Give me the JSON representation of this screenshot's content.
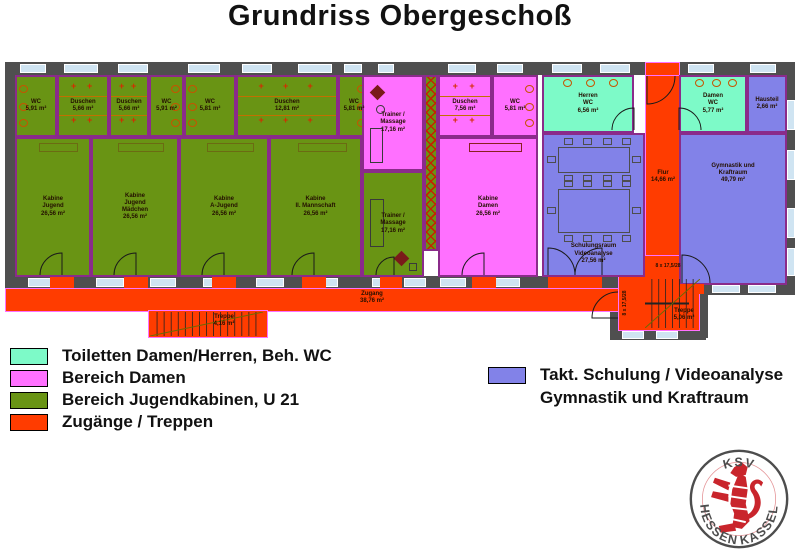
{
  "title": "Grundriss Obergeschoß",
  "colors": {
    "olive": "#699414",
    "pink": "#FF70FF",
    "teal": "#7DFAC8",
    "purple": "#8282E8",
    "orange": "#FF3C00",
    "wall": "#4F4F4F",
    "window": "#CFE4F2",
    "room_border": "#8A2B8A",
    "accent_red": "#D42B00"
  },
  "plan": {
    "walls": [
      [
        5,
        62,
        790,
        13
      ],
      [
        5,
        62,
        10,
        228
      ],
      [
        785,
        62,
        10,
        233
      ],
      [
        5,
        276,
        617,
        12
      ],
      [
        700,
        283,
        95,
        12
      ],
      [
        610,
        300,
        8,
        38
      ],
      [
        610,
        330,
        96,
        10
      ],
      [
        700,
        295,
        8,
        43
      ]
    ],
    "orange_areas": [
      {
        "name": "corridor-zugang",
        "x": 5,
        "y": 288,
        "w": 617,
        "h": 24
      },
      {
        "name": "stair-left-area",
        "x": 148,
        "y": 310,
        "w": 120,
        "h": 28
      },
      {
        "name": "flur-corridor",
        "x": 645,
        "y": 75,
        "w": 35,
        "h": 215
      },
      {
        "name": "entrance-top",
        "x": 645,
        "y": 62,
        "w": 35,
        "h": 14
      },
      {
        "name": "stair-right-area",
        "x": 618,
        "y": 255,
        "w": 82,
        "h": 76
      }
    ],
    "rooms": [
      {
        "name": "wc-1",
        "fill": "olive",
        "x": 15,
        "y": 75,
        "w": 42,
        "h": 62,
        "lines": [
          "WC",
          "5,91 m²"
        ],
        "f": [
          {
            "t": "wc",
            "side": "l"
          }
        ]
      },
      {
        "name": "duschen-1",
        "fill": "olive",
        "x": 57,
        "y": 75,
        "w": 52,
        "h": 62,
        "lines": [
          "Duschen",
          "5,66 m²"
        ],
        "f": [
          {
            "t": "shower"
          }
        ]
      },
      {
        "name": "duschen-2",
        "fill": "olive",
        "x": 109,
        "y": 75,
        "w": 40,
        "h": 62,
        "lines": [
          "Duschen",
          "5,66 m²"
        ],
        "f": [
          {
            "t": "shower"
          }
        ]
      },
      {
        "name": "wc-2",
        "fill": "olive",
        "x": 149,
        "y": 75,
        "w": 35,
        "h": 62,
        "lines": [
          "WC",
          "5,91 m²"
        ],
        "f": [
          {
            "t": "wc",
            "side": "r"
          }
        ]
      },
      {
        "name": "wc-3",
        "fill": "olive",
        "x": 184,
        "y": 75,
        "w": 52,
        "h": 62,
        "lines": [
          "WC",
          "5,81 m²"
        ],
        "f": [
          {
            "t": "wc",
            "side": "l"
          }
        ]
      },
      {
        "name": "duschen-3",
        "fill": "olive",
        "x": 236,
        "y": 75,
        "w": 102,
        "h": 62,
        "lines": [
          "Duschen",
          "12,81 m²"
        ],
        "f": [
          {
            "t": "shower"
          }
        ]
      },
      {
        "name": "wc-4",
        "fill": "olive",
        "x": 338,
        "y": 75,
        "w": 32,
        "h": 62,
        "lines": [
          "WC",
          "5,81 m²"
        ],
        "f": [
          {
            "t": "wc",
            "side": "r"
          }
        ]
      },
      {
        "name": "kabine-jugend",
        "fill": "olive",
        "x": 15,
        "y": 137,
        "w": 76,
        "h": 140,
        "lines": [
          "Kabine",
          "Jugend",
          "26,56 m²"
        ],
        "f": [
          {
            "t": "rect",
            "x": "30%",
            "y": 4,
            "w": "55%",
            "h": 9,
            "bc": "#6b6b13"
          }
        ]
      },
      {
        "name": "kabine-jugend-maedchen",
        "fill": "olive",
        "x": 91,
        "y": 137,
        "w": 88,
        "h": 140,
        "lines": [
          "Kabine",
          "Jugend",
          "Mädchen",
          "26,56 m²"
        ],
        "f": [
          {
            "t": "rect",
            "x": "30%",
            "y": 4,
            "w": "55%",
            "h": 9,
            "bc": "#6b6b13"
          }
        ]
      },
      {
        "name": "kabine-a-jugend",
        "fill": "olive",
        "x": 179,
        "y": 137,
        "w": 90,
        "h": 140,
        "lines": [
          "Kabine",
          "A-Jugend",
          "26,56 m²"
        ],
        "f": [
          {
            "t": "rect",
            "x": "30%",
            "y": 4,
            "w": "55%",
            "h": 9,
            "bc": "#6b6b13"
          }
        ]
      },
      {
        "name": "kabine-2-mannschaft",
        "fill": "olive",
        "x": 269,
        "y": 137,
        "w": 93,
        "h": 140,
        "lines": [
          "Kabine",
          "II. Mannschaft",
          "26,56 m²"
        ],
        "f": [
          {
            "t": "rect",
            "x": "30%",
            "y": 4,
            "w": "55%",
            "h": 9,
            "bc": "#6b6b13"
          }
        ]
      },
      {
        "name": "trainer-massage-damen",
        "fill": "pink",
        "x": 362,
        "y": 75,
        "w": 62,
        "h": 96,
        "lines": [
          "Trainer /",
          "Massage",
          "17,16 m²"
        ],
        "f": [
          {
            "t": "diamond",
            "x": 8,
            "y": 10,
            "s": 11
          },
          {
            "t": "ring",
            "x": 12,
            "y": 28,
            "d": 9
          },
          {
            "t": "rect",
            "x": 6,
            "y": "55%",
            "w": 13,
            "h": "38%"
          }
        ]
      },
      {
        "name": "trainer-massage-jugend",
        "fill": "olive",
        "x": 362,
        "y": 171,
        "w": 62,
        "h": 106,
        "lines": [
          "Trainer /",
          "Massage",
          "17,16 m²"
        ],
        "f": [
          {
            "t": "rect",
            "x": 6,
            "y": 26,
            "w": 14,
            "h": 48
          },
          {
            "t": "diamond",
            "x": "55%",
            "y": "78%",
            "s": 11
          },
          {
            "t": "rect",
            "x": "78%",
            "y": "88%",
            "w": 8,
            "h": 8
          }
        ]
      },
      {
        "name": "schrankzeile",
        "fill": "olive",
        "x": 424,
        "y": 75,
        "w": 14,
        "h": 176,
        "lines": [],
        "f": [
          {
            "t": "hatch"
          }
        ]
      },
      {
        "name": "duschen-damen",
        "fill": "pink",
        "x": 438,
        "y": 75,
        "w": 54,
        "h": 62,
        "lines": [
          "Duschen",
          "7,56 m²"
        ],
        "f": [
          {
            "t": "shower"
          }
        ]
      },
      {
        "name": "wc-damen-bereich",
        "fill": "pink",
        "x": 492,
        "y": 75,
        "w": 46,
        "h": 62,
        "lines": [
          "WC",
          "5,81 m²"
        ],
        "f": [
          {
            "t": "wc",
            "side": "r"
          }
        ]
      },
      {
        "name": "kabine-damen",
        "fill": "pink",
        "x": 438,
        "y": 137,
        "w": 100,
        "h": 140,
        "lines": [
          "Kabine",
          "Damen",
          "26,56 m²"
        ],
        "f": [
          {
            "t": "rect",
            "x": "30%",
            "y": 4,
            "w": "55%",
            "h": 9,
            "bc": "#8a2020"
          }
        ]
      },
      {
        "name": "herren-wc",
        "fill": "teal",
        "x": 542,
        "y": 75,
        "w": 92,
        "h": 58,
        "lines": [
          "Herren",
          "WC",
          "6,56 m²"
        ],
        "f": [
          {
            "t": "wc",
            "side": "t"
          }
        ]
      },
      {
        "name": "damen-wc",
        "fill": "teal",
        "x": 679,
        "y": 75,
        "w": 68,
        "h": 58,
        "lines": [
          "Damen",
          "WC",
          "5,77 m²"
        ],
        "f": [
          {
            "t": "wc",
            "side": "t"
          }
        ]
      },
      {
        "name": "hausteil",
        "fill": "purple",
        "x": 747,
        "y": 75,
        "w": 40,
        "h": 58,
        "lines": [
          "Hausteil",
          "2,66 m²"
        ],
        "f": []
      },
      {
        "name": "schulungsraum-videoanalyse",
        "fill": "purple",
        "x": 542,
        "y": 133,
        "w": 103,
        "h": 144,
        "pos": "bottom",
        "lines": [
          "Schulungsraum",
          "Videoanalyse",
          "27,56 m²"
        ],
        "f": [
          {
            "t": "tables"
          }
        ]
      },
      {
        "name": "gymnastik-kraftraum",
        "fill": "purple",
        "x": 679,
        "y": 133,
        "w": 108,
        "h": 152,
        "pos": "top",
        "lines": [
          "Gymnastik und",
          "Kraftraum",
          "49,79 m²"
        ],
        "f": []
      }
    ],
    "windows": [
      [
        20,
        64,
        26,
        9
      ],
      [
        64,
        64,
        34,
        9
      ],
      [
        118,
        64,
        30,
        9
      ],
      [
        188,
        64,
        32,
        9
      ],
      [
        242,
        64,
        30,
        9
      ],
      [
        298,
        64,
        34,
        9
      ],
      [
        344,
        64,
        18,
        9
      ],
      [
        378,
        64,
        16,
        9
      ],
      [
        448,
        64,
        28,
        9
      ],
      [
        497,
        64,
        26,
        9
      ],
      [
        552,
        64,
        30,
        9
      ],
      [
        600,
        64,
        30,
        9
      ],
      [
        688,
        64,
        26,
        9
      ],
      [
        750,
        64,
        26,
        9
      ],
      [
        28,
        278,
        30,
        9
      ],
      [
        96,
        278,
        28,
        9
      ],
      [
        150,
        278,
        26,
        9
      ],
      [
        203,
        278,
        28,
        9
      ],
      [
        256,
        278,
        28,
        9
      ],
      [
        310,
        278,
        28,
        9
      ],
      [
        372,
        278,
        22,
        9
      ],
      [
        404,
        278,
        22,
        9
      ],
      [
        440,
        278,
        26,
        9
      ],
      [
        494,
        278,
        26,
        9
      ],
      [
        712,
        285,
        28,
        8
      ],
      [
        748,
        285,
        28,
        8
      ],
      [
        787,
        100,
        8,
        30
      ],
      [
        787,
        150,
        8,
        30
      ],
      [
        787,
        208,
        8,
        30
      ],
      [
        787,
        248,
        8,
        28
      ],
      [
        622,
        331,
        22,
        8
      ],
      [
        656,
        331,
        22,
        8
      ]
    ],
    "thresholds": [
      [
        50,
        277,
        24,
        11
      ],
      [
        124,
        277,
        24,
        11
      ],
      [
        212,
        277,
        24,
        11
      ],
      [
        302,
        277,
        24,
        11
      ],
      [
        380,
        277,
        22,
        11
      ],
      [
        472,
        277,
        24,
        11
      ],
      [
        548,
        277,
        54,
        11
      ],
      [
        680,
        284,
        24,
        10
      ],
      [
        646,
        63,
        33,
        12
      ]
    ],
    "stairs": [
      {
        "name": "treppe-links",
        "x": 150,
        "y": 312,
        "w": 113,
        "h": 24,
        "n": 16,
        "mid": false
      },
      {
        "name": "treppe-rechts",
        "x": 645,
        "y": 279,
        "w": 55,
        "h": 49,
        "n": 8,
        "mid": true
      }
    ],
    "doors": [
      {
        "h": [
          62,
          275
        ],
        "a": [
          40,
          275
        ],
        "b": [
          62,
          253
        ],
        "s": 1
      },
      {
        "h": [
          136,
          275
        ],
        "a": [
          114,
          275
        ],
        "b": [
          136,
          253
        ],
        "s": 1
      },
      {
        "h": [
          224,
          275
        ],
        "a": [
          202,
          275
        ],
        "b": [
          224,
          253
        ],
        "s": 1
      },
      {
        "h": [
          314,
          275
        ],
        "a": [
          292,
          275
        ],
        "b": [
          314,
          253
        ],
        "s": 1
      },
      {
        "h": [
          484,
          275
        ],
        "a": [
          462,
          275
        ],
        "b": [
          484,
          253
        ],
        "s": 1
      },
      {
        "h": [
          394,
          275
        ],
        "a": [
          376,
          275
        ],
        "b": [
          394,
          257
        ],
        "s": 1
      },
      {
        "h": [
          548,
          275
        ],
        "a": [
          575,
          275
        ],
        "b": [
          548,
          248
        ],
        "s": 0
      },
      {
        "h": [
          602,
          275
        ],
        "a": [
          575,
          275
        ],
        "b": [
          602,
          248
        ],
        "s": 1
      },
      {
        "h": [
          682,
          283
        ],
        "a": [
          710,
          283
        ],
        "b": [
          682,
          255
        ],
        "s": 0
      },
      {
        "h": [
          647,
          76
        ],
        "a": [
          675,
          76
        ],
        "b": [
          647,
          104
        ],
        "s": 1
      },
      {
        "h": [
          634,
          130
        ],
        "a": [
          612,
          130
        ],
        "b": [
          634,
          108
        ],
        "s": 1
      },
      {
        "h": [
          679,
          130
        ],
        "a": [
          701,
          130
        ],
        "b": [
          679,
          108
        ],
        "s": 0
      },
      {
        "h": [
          618,
          318
        ],
        "a": [
          618,
          292
        ],
        "b": [
          592,
          318
        ],
        "s": 0
      }
    ],
    "free_labels": [
      {
        "name": "zugang-label",
        "x": 350,
        "y": 291,
        "w": 44,
        "lines": [
          "Zugang",
          "38,76 m²"
        ]
      },
      {
        "name": "flur-label",
        "x": 645,
        "y": 170,
        "w": 36,
        "lines": [
          "Flur",
          "14,66 m²"
        ]
      },
      {
        "name": "treppe-links-label",
        "x": 206,
        "y": 314,
        "w": 36,
        "lines": [
          "Treppe",
          "4,16 m²"
        ]
      },
      {
        "name": "treppe-rechts-label",
        "x": 666,
        "y": 308,
        "w": 36,
        "lines": [
          "Treppe",
          "5,06 m²"
        ]
      },
      {
        "name": "stair-note-1",
        "x": 645,
        "y": 263,
        "w": 46,
        "size": 5,
        "lines": [
          "8 x 17,5/28"
        ]
      },
      {
        "name": "stair-note-2",
        "x": 602,
        "y": 300,
        "w": 46,
        "size": 5,
        "rot": -90,
        "lines": [
          "8 x 17,5/28"
        ]
      }
    ]
  },
  "legend_left": [
    {
      "color": "teal",
      "label": "Toiletten Damen/Herren, Beh. WC"
    },
    {
      "color": "pink",
      "label": "Bereich Damen"
    },
    {
      "color": "olive",
      "label": "Bereich Jugendkabinen, U 21"
    },
    {
      "color": "orange",
      "label": "Zugänge / Treppen"
    }
  ],
  "legend_right": {
    "color": "purple",
    "lines": [
      "Takt. Schulung / Videoanalyse",
      "Gymnastik und Kraftraum"
    ]
  },
  "logo": {
    "top": "KSV",
    "bottom_left": "HESSEN",
    "bottom_right": "KASSEL"
  }
}
